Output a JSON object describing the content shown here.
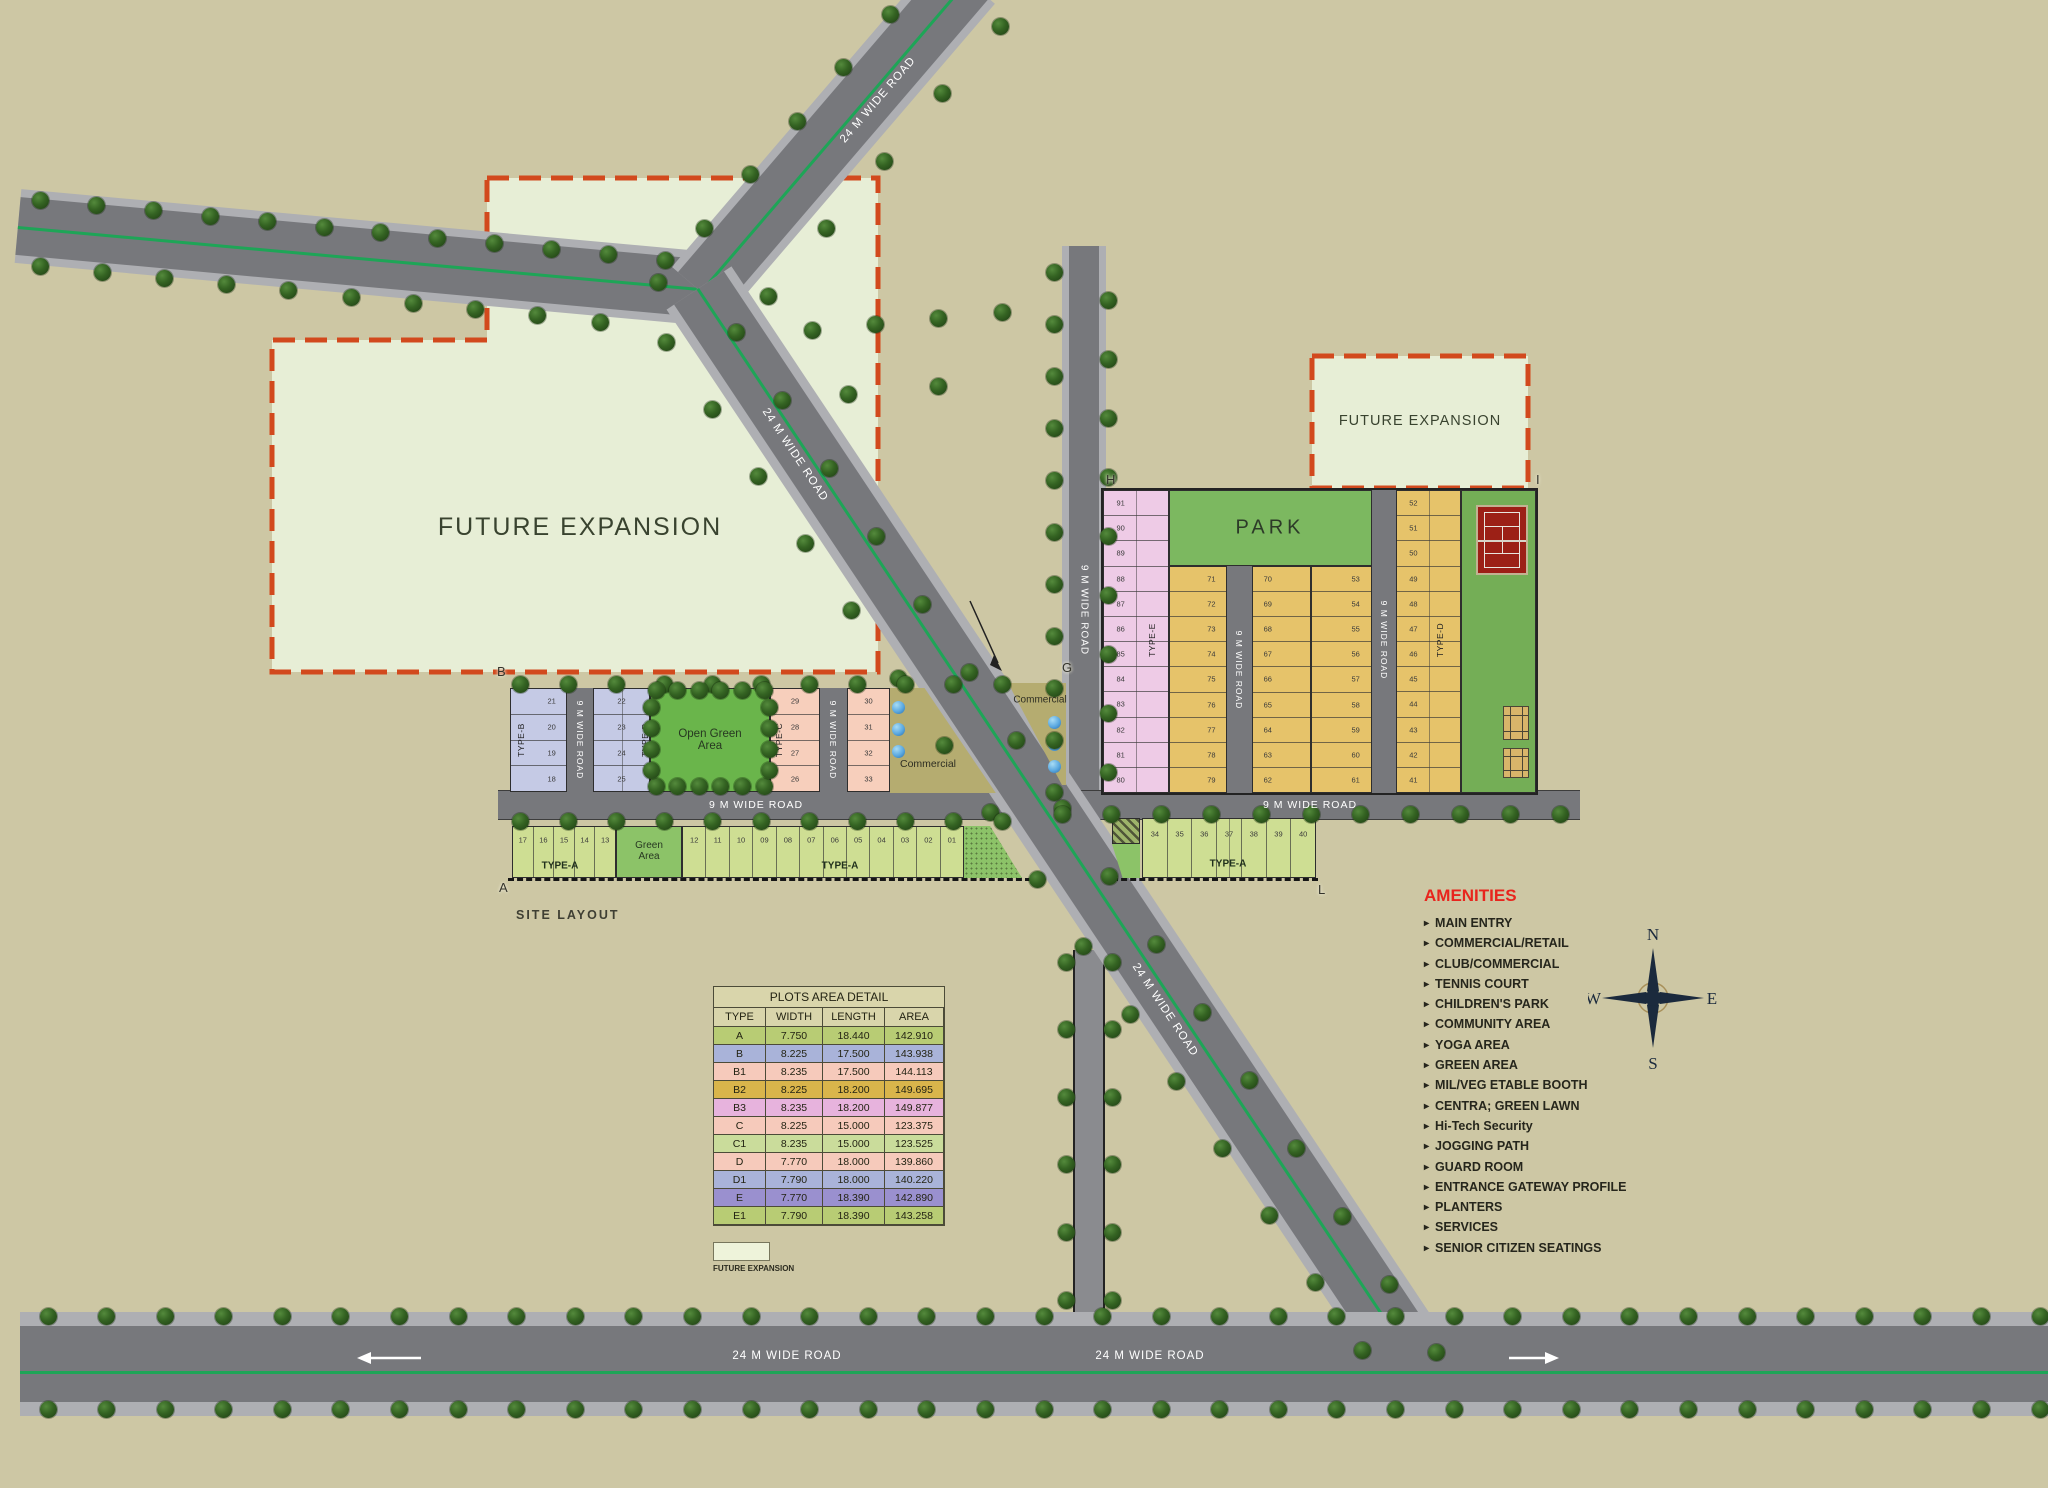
{
  "site": {
    "title": "SITE LAYOUT",
    "future_expansion": "FUTURE EXPANSION",
    "park": "PARK",
    "open_green_area": "Open Green Area",
    "green_area": "Green Area",
    "commercial": "Commercial",
    "road_24m": "24 M WIDE ROAD",
    "road_9m": "9 M WIDE ROAD",
    "corner_labels": {
      "a": "A",
      "b": "B",
      "g": "G",
      "h": "H",
      "i": "I",
      "l": "L"
    }
  },
  "type_labels": {
    "a": "TYPE-A",
    "b": "TYPE-B",
    "c": "TYPE-C",
    "d": "TYPE-D",
    "e": "TYPE-E"
  },
  "plots": {
    "north_b1": [
      "21",
      "20",
      "19",
      "18"
    ],
    "north_b2": [
      "22",
      "23",
      "24",
      "25"
    ],
    "north_c1": [
      "29",
      "28",
      "27",
      "26"
    ],
    "north_c2": [
      "30",
      "31",
      "32",
      "33"
    ],
    "south_a_left": [
      "17",
      "16",
      "15",
      "14",
      "13"
    ],
    "south_a_right": [
      "12",
      "11",
      "10",
      "09",
      "08",
      "07",
      "06",
      "05",
      "04",
      "03",
      "02",
      "01"
    ],
    "east_e": [
      "91",
      "90",
      "89",
      "88",
      "87",
      "86",
      "85",
      "84",
      "83",
      "82",
      "81",
      "80"
    ],
    "east_col71": [
      "71",
      "72",
      "73",
      "74",
      "75",
      "76",
      "77",
      "78",
      "79"
    ],
    "east_col70": [
      "70",
      "69",
      "68",
      "67",
      "66",
      "65",
      "64",
      "63",
      "62"
    ],
    "east_col53": [
      "53",
      "54",
      "55",
      "56",
      "57",
      "58",
      "59",
      "60",
      "61"
    ],
    "east_d": [
      "52",
      "51",
      "50",
      "49",
      "48",
      "47",
      "46",
      "45",
      "44",
      "43",
      "42",
      "41"
    ],
    "southeast_a": [
      "34",
      "35",
      "36",
      "37",
      "38",
      "39",
      "40"
    ]
  },
  "plots_table": {
    "title": "PLOTS AREA DETAIL",
    "headers": [
      "TYPE",
      "WIDTH",
      "LENGTH",
      "AREA"
    ],
    "rows": [
      {
        "type": "A",
        "width": "7.750",
        "length": "18.440",
        "area": "142.910",
        "color": "#b8cc74"
      },
      {
        "type": "B",
        "width": "8.225",
        "length": "17.500",
        "area": "143.938",
        "color": "#a9b3d9"
      },
      {
        "type": "B1",
        "width": "8.235",
        "length": "17.500",
        "area": "144.113",
        "color": "#f6cabb"
      },
      {
        "type": "B2",
        "width": "8.225",
        "length": "18.200",
        "area": "149.695",
        "color": "#d9b54b"
      },
      {
        "type": "B3",
        "width": "8.235",
        "length": "18.200",
        "area": "149.877",
        "color": "#e7b3dd"
      },
      {
        "type": "C",
        "width": "8.225",
        "length": "15.000",
        "area": "123.375",
        "color": "#f6cabb"
      },
      {
        "type": "C1",
        "width": "8.235",
        "length": "15.000",
        "area": "123.525",
        "color": "#cadc9b"
      },
      {
        "type": "D",
        "width": "7.770",
        "length": "18.000",
        "area": "139.860",
        "color": "#f6cabb"
      },
      {
        "type": "D1",
        "width": "7.790",
        "length": "18.000",
        "area": "140.220",
        "color": "#a9b3d9"
      },
      {
        "type": "E",
        "width": "7.770",
        "length": "18.390",
        "area": "142.890",
        "color": "#9a90cf"
      },
      {
        "type": "E1",
        "width": "7.790",
        "length": "18.390",
        "area": "143.258",
        "color": "#b8cc74"
      }
    ]
  },
  "legend": {
    "future_expansion": "FUTURE EXPANSION"
  },
  "amenities": {
    "title": "AMENITIES",
    "items": [
      "MAIN ENTRY",
      "COMMERCIAL/RETAIL",
      "CLUB/COMMERCIAL",
      "TENNIS COURT",
      "CHILDREN'S PARK",
      "COMMUNITY AREA",
      "YOGA AREA",
      "GREEN AREA",
      "MIL/VEG ETABLE BOOTH",
      "CENTRA; GREEN LAWN",
      "Hi-Tech Security",
      "JOGGING PATH",
      "GUARD ROOM",
      "ENTRANCE GATEWAY PROFILE",
      "PLANTERS",
      "SERVICES",
      "SENIOR CITIZEN SEATINGS"
    ]
  },
  "compass": {
    "n": "N",
    "e": "E",
    "s": "S",
    "w": "W"
  },
  "colors": {
    "background": "#cdc7a4",
    "road": "#77787c",
    "road_edge": "#aeafb3",
    "centerline": "#1ea557",
    "future_expansion_fill": "#e7eed6",
    "dashed_border": "#d2491d",
    "park": "#7cb860",
    "open_green": "#6ab54b",
    "green_area": "#8cc368",
    "plot_a": "#cede93",
    "plot_b": "#c5cae5",
    "plot_c": "#f7cfbc",
    "plot_d": "#e6c36a",
    "plot_e": "#eecbe6",
    "commercial": "#b5ac70",
    "tennis": "#9c2016",
    "amenities_title": "#e8251d"
  }
}
